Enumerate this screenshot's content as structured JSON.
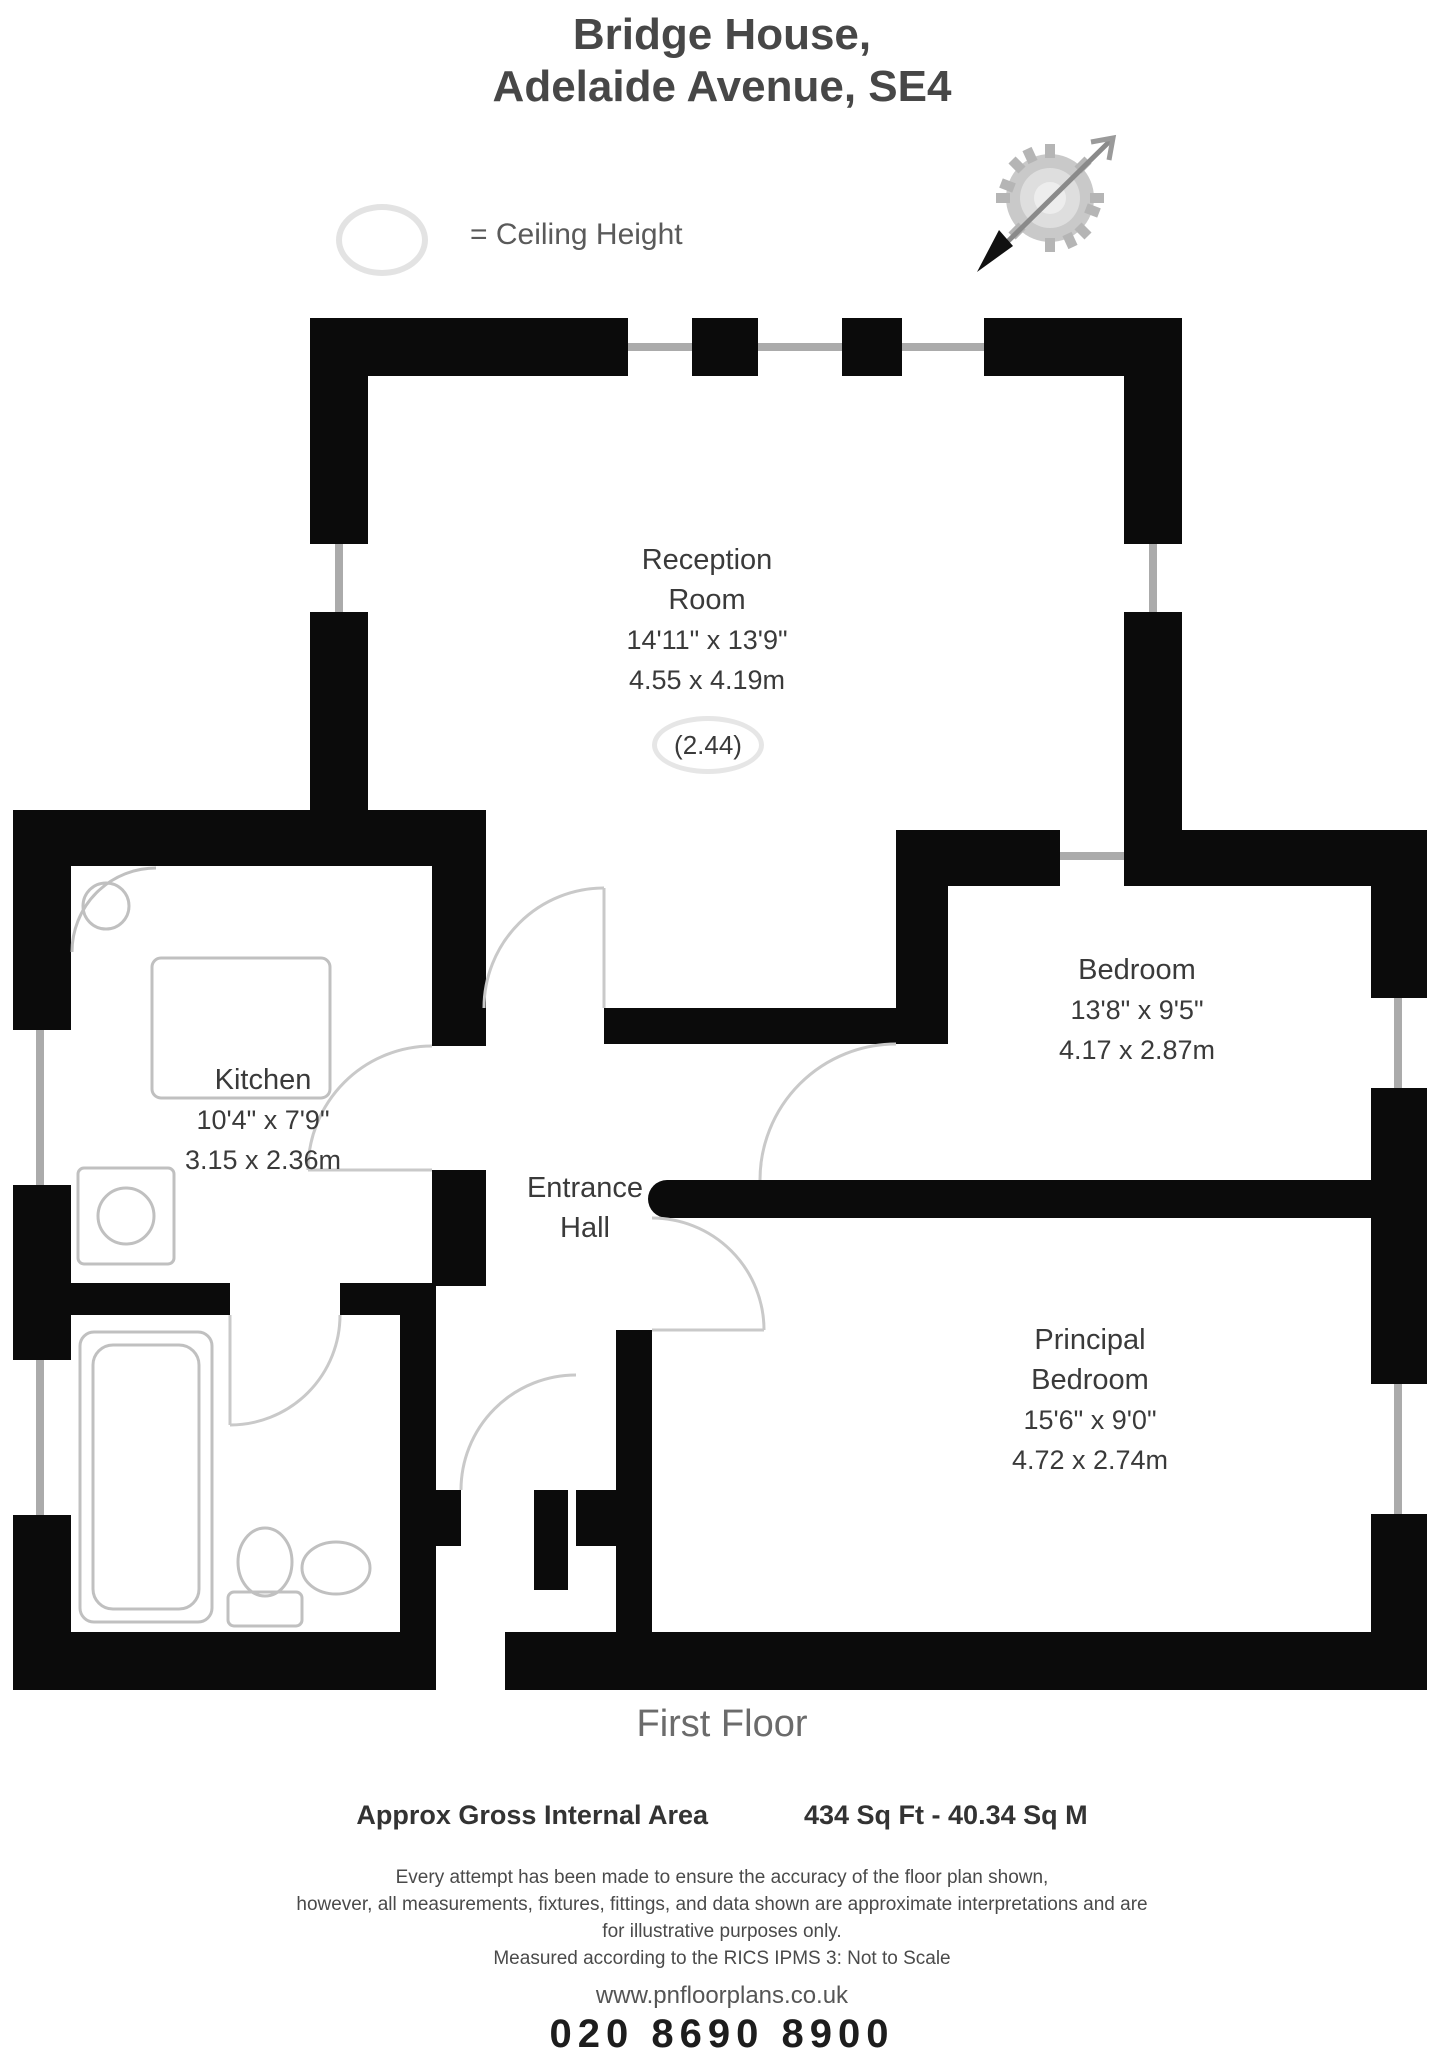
{
  "title": {
    "line1": "Bridge House,",
    "line2": "Adelaide Avenue, SE4"
  },
  "legend": {
    "label": "= Ceiling Height",
    "symbol": "ceiling-height-ellipse"
  },
  "compass": {
    "symbol": "north-arrow-compass"
  },
  "rooms": {
    "reception": {
      "line1": "Reception",
      "line2": "Room",
      "imperial": "14'11\" x 13'9\"",
      "metric": "4.55 x 4.19m",
      "ceiling": "(2.44)"
    },
    "bedroom": {
      "line1": "Bedroom",
      "imperial": "13'8\" x 9'5\"",
      "metric": "4.17 x 2.87m"
    },
    "kitchen": {
      "line1": "Kitchen",
      "imperial": "10'4\" x 7'9\"",
      "metric": "3.15 x 2.36m"
    },
    "hall": {
      "line1": "Entrance",
      "line2": "Hall"
    },
    "principal": {
      "line1": "Principal",
      "line2": "Bedroom",
      "imperial": "15'6\" x 9'0\"",
      "metric": "4.72 x 2.74m"
    }
  },
  "floor_label": "First Floor",
  "footer": {
    "area_label": "Approx Gross Internal Area",
    "area_value": "434 Sq Ft - 40.34 Sq M",
    "disclaimer_lines": [
      "Every attempt has been made to ensure the accuracy of the floor plan shown,",
      "however, all measurements, fixtures, fittings, and data shown are approximate interpretations and are",
      "for illustrative purposes only.",
      "Measured according to the RICS IPMS 3: Not to Scale"
    ],
    "website": "www.pnfloorplans.co.uk",
    "phone": "020 8690 8900"
  },
  "colors": {
    "wall": "#0b0b0b",
    "window_line": "#ababab",
    "fixture_line": "#c0c0c0",
    "text": "#3a3a3a"
  }
}
